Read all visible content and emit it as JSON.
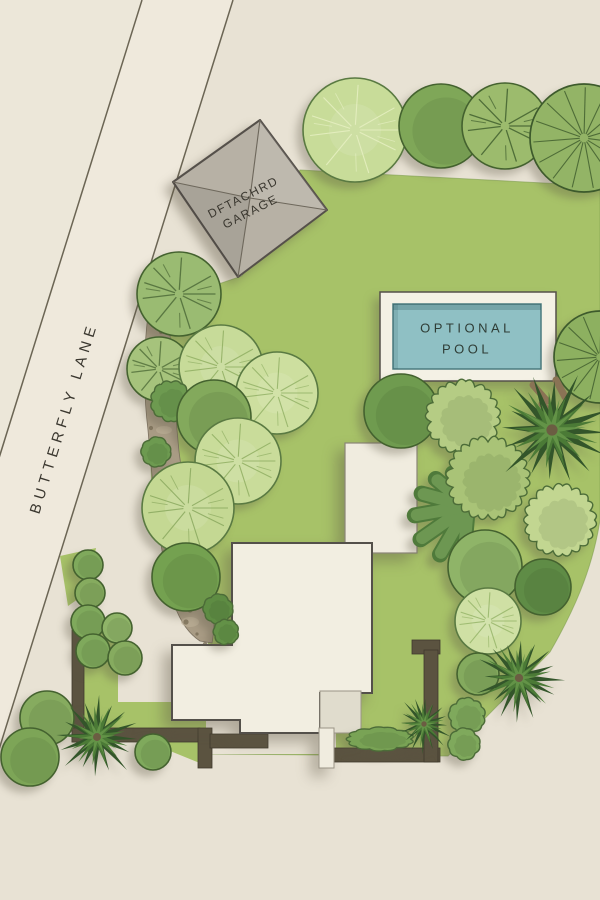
{
  "labels": {
    "road": "BUTTERFLY LANE",
    "garage_line1": "DFTACHRD",
    "garage_line2": "GARAGE",
    "pool_line1": "OPTIONAL",
    "pool_line2": "POOL"
  },
  "palette": {
    "background": "#e8e2d4",
    "road_surface": "#efe9dc",
    "road_side": "#ece7d9",
    "road_edge": "#6b6554",
    "lawn": "#a7c268",
    "lawn_edge": "#7f9e50",
    "mulch": "#a99c85",
    "wall": "#5b5340",
    "house": "#f2eee1",
    "house_outline": "#54504a",
    "pad": "#f0ecdf",
    "step": "#e0dccd",
    "garage": "#b7b1a5",
    "garage_outline": "#55504a",
    "pool_deck": "#f4f1e5",
    "pool_water": "#8fc0c4",
    "pool_water_edge": "#4a7a7e",
    "pool_text": "#2f3d36",
    "label_text": "#3a372f",
    "tree_outline": "#44622f"
  }
}
